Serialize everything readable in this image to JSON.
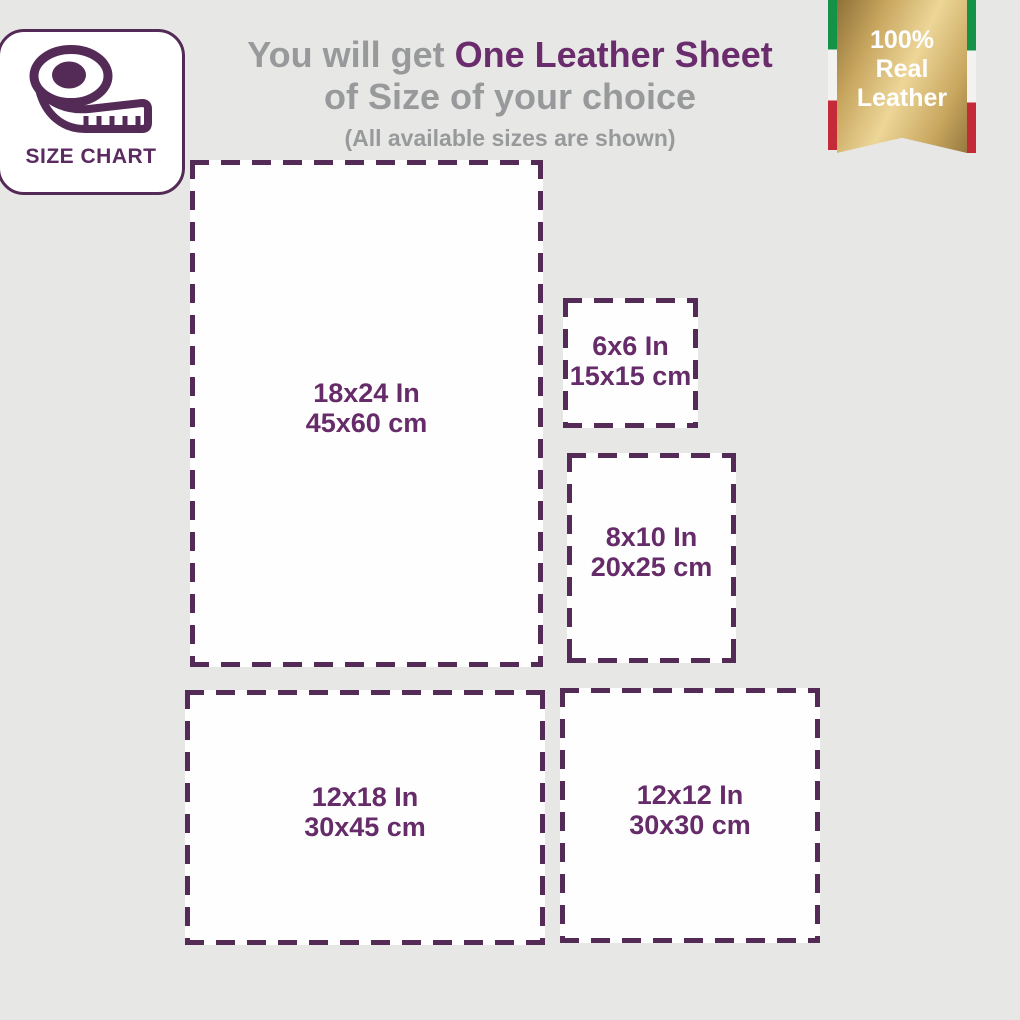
{
  "colors": {
    "background": "#e7e7e5",
    "dash_purple": "#542a57",
    "label_purple": "#662b69",
    "title_purple": "#6b2c6e",
    "gray_text": "#97999b",
    "ribbon_green": "#149247",
    "ribbon_red": "#c42a38",
    "gold_light": "#edd698",
    "gold_dark": "#8e7138"
  },
  "badge": {
    "label": "SIZE CHART",
    "icon": "tape-measure-icon"
  },
  "header": {
    "title_prefix": "You will get ",
    "title_highlight": "One Leather Sheet",
    "title_line2": "of Size of your choice",
    "subtitle": "(All available sizes are shown)"
  },
  "ribbon": {
    "line1": "100%",
    "line2": "Real",
    "line3": "Leather"
  },
  "sizes": [
    {
      "inches": "18x24 In",
      "cm": "45x60 cm"
    },
    {
      "inches": "6x6 In",
      "cm": "15x15 cm"
    },
    {
      "inches": "8x10 In",
      "cm": "20x25 cm"
    },
    {
      "inches": "12x18 In",
      "cm": "30x45 cm"
    },
    {
      "inches": "12x12 In",
      "cm": "30x30 cm"
    }
  ]
}
